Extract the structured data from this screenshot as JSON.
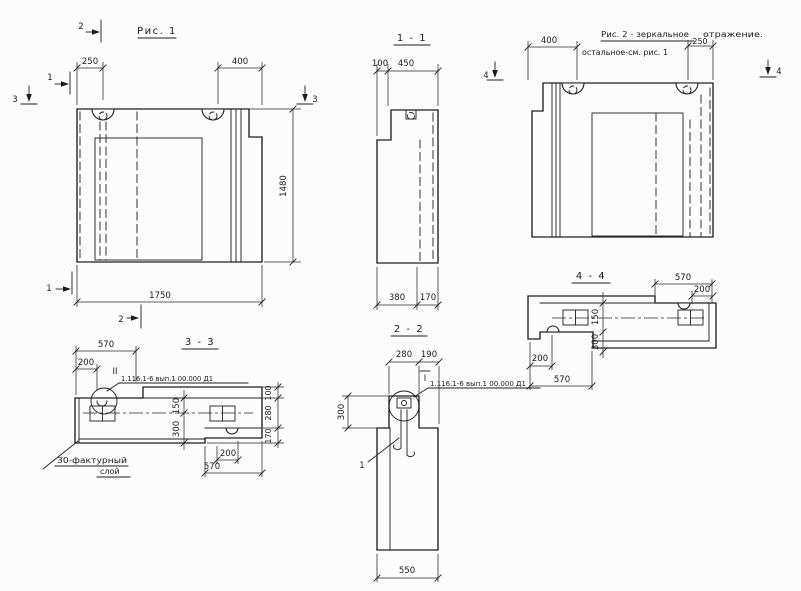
{
  "fig1": {
    "title": "Рис. 1",
    "d250": "250",
    "d400": "400",
    "d1480": "1480",
    "d1750": "1750",
    "m1": "1",
    "m2": "2",
    "m3": "3"
  },
  "sec11": {
    "title": "1 - 1",
    "d100": "100",
    "d450": "450",
    "d380": "380",
    "d170": "170",
    "m4": "4"
  },
  "fig2": {
    "title": "Рис. 2 - зеркальное",
    "title_tail": "отражение.",
    "subtitle": "остальное-см. рис. 1",
    "d400": "400",
    "d250": "250",
    "m4": "4"
  },
  "sec44": {
    "title": "4 - 4",
    "d570t": "570",
    "d200t": "200",
    "d150": "150",
    "d300": "300",
    "d200b": "200",
    "d570b": "570"
  },
  "sec33": {
    "title": "3 - 3",
    "d570t": "570",
    "d200t": "200",
    "d150": "150",
    "d300": "300",
    "d100": "100",
    "d280": "280",
    "d170": "170",
    "d200b": "200",
    "d570b": "570",
    "callout": "II",
    "designation": "1.116.1-6 вып.1 00.000 Д1",
    "note1": "30-фактурный",
    "note2": "слой"
  },
  "sec22": {
    "title": "2 - 2",
    "d280": "280",
    "d190": "190",
    "d300": "300",
    "d550": "550",
    "callout": "I",
    "designation": "1.116.1-6 вып.1 00.000 Д1",
    "leader": "1"
  }
}
